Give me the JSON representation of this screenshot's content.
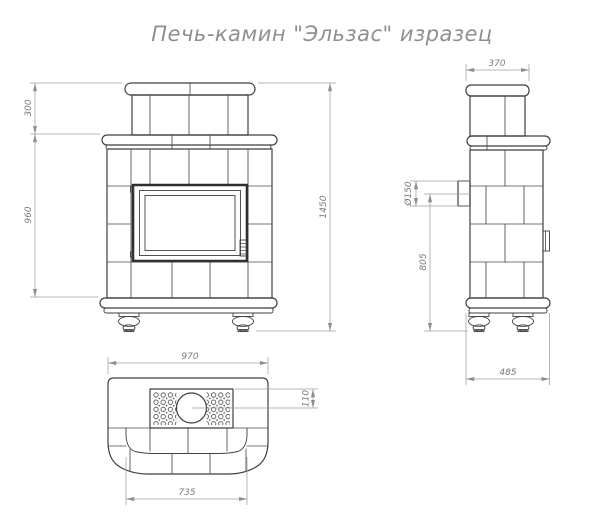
{
  "title": "Печь-камин \"Эльзас\" изразец",
  "views": {
    "front": {
      "dims": {
        "upper_section_height": "300",
        "body_height": "960",
        "total_height": "1450"
      }
    },
    "side": {
      "dims": {
        "chimney_depth": "370",
        "flue_diameter": "Ø150",
        "flue_axis_height": "805",
        "base_depth": "485"
      }
    },
    "top": {
      "dims": {
        "overall_width": "970",
        "flue_center_offset": "110",
        "body_width": "735"
      }
    }
  },
  "colors": {
    "background": "#ffffff",
    "line": "#3f3f3f",
    "dimension_line": "#9aa0a3",
    "dimension_text": "#75787c",
    "title_text": "#8c9093"
  }
}
